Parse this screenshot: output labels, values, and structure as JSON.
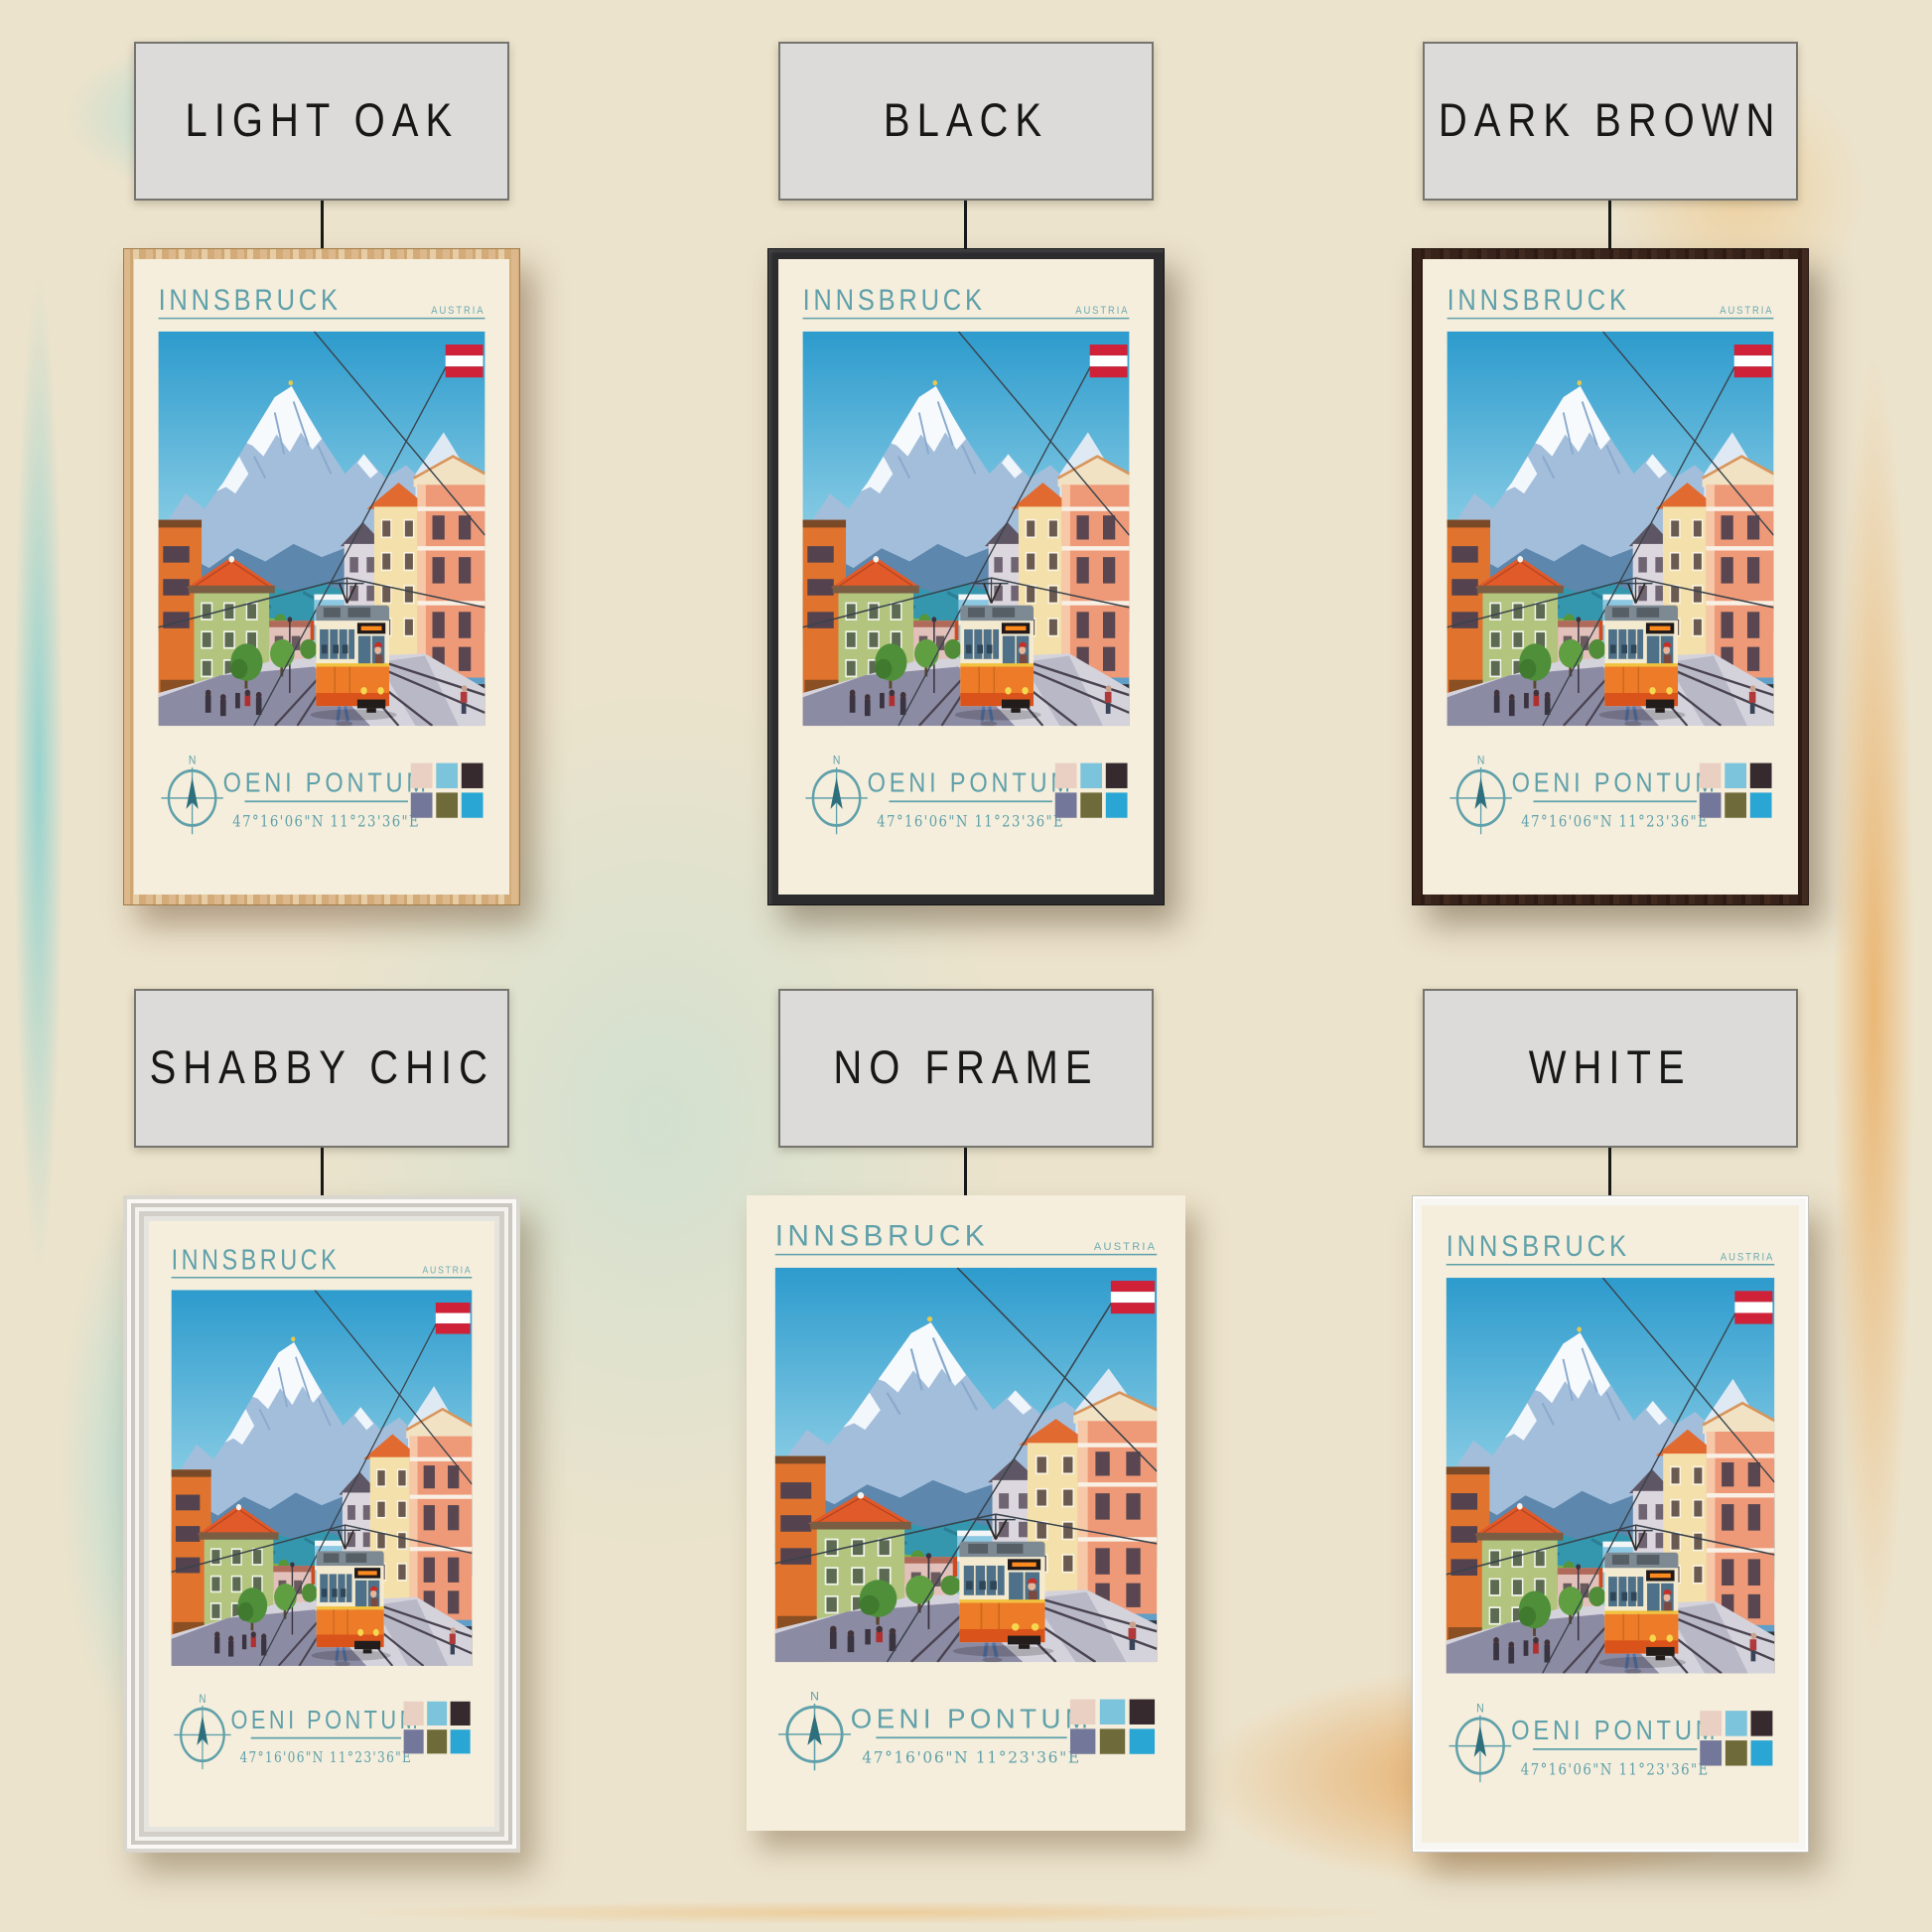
{
  "variants": [
    {
      "id": "light-oak",
      "label": "LIGHT OAK",
      "frame_color": "#d7b183"
    },
    {
      "id": "black",
      "label": "BLACK",
      "frame_color": "#2c2c2e"
    },
    {
      "id": "dark-brown",
      "label": "DARK BROWN",
      "frame_color": "#38231a"
    },
    {
      "id": "shabby-chic",
      "label": "SHABBY CHIC",
      "frame_color": "#edebe6"
    },
    {
      "id": "no-frame",
      "label": "NO FRAME",
      "frame_color": null
    },
    {
      "id": "white",
      "label": "WHITE",
      "frame_color": "#f7f6f2"
    }
  ],
  "poster": {
    "title": "INNSBRUCK",
    "country": "AUSTRIA",
    "subtitle": "OENI PONTUM",
    "coordinates": "47°16'06\"N 11°23'36\"E",
    "compass_label": "N",
    "paper_color": "#f5eedc",
    "accent_teal": "#5fa0aa",
    "flag_colors": [
      "#cf2137",
      "#ffffff",
      "#cf2137"
    ],
    "palette_swatches": [
      "#e9d0c2",
      "#7cc3dc",
      "#372a2e",
      "#73789a",
      "#6f6a3a",
      "#2aa6d5"
    ]
  }
}
